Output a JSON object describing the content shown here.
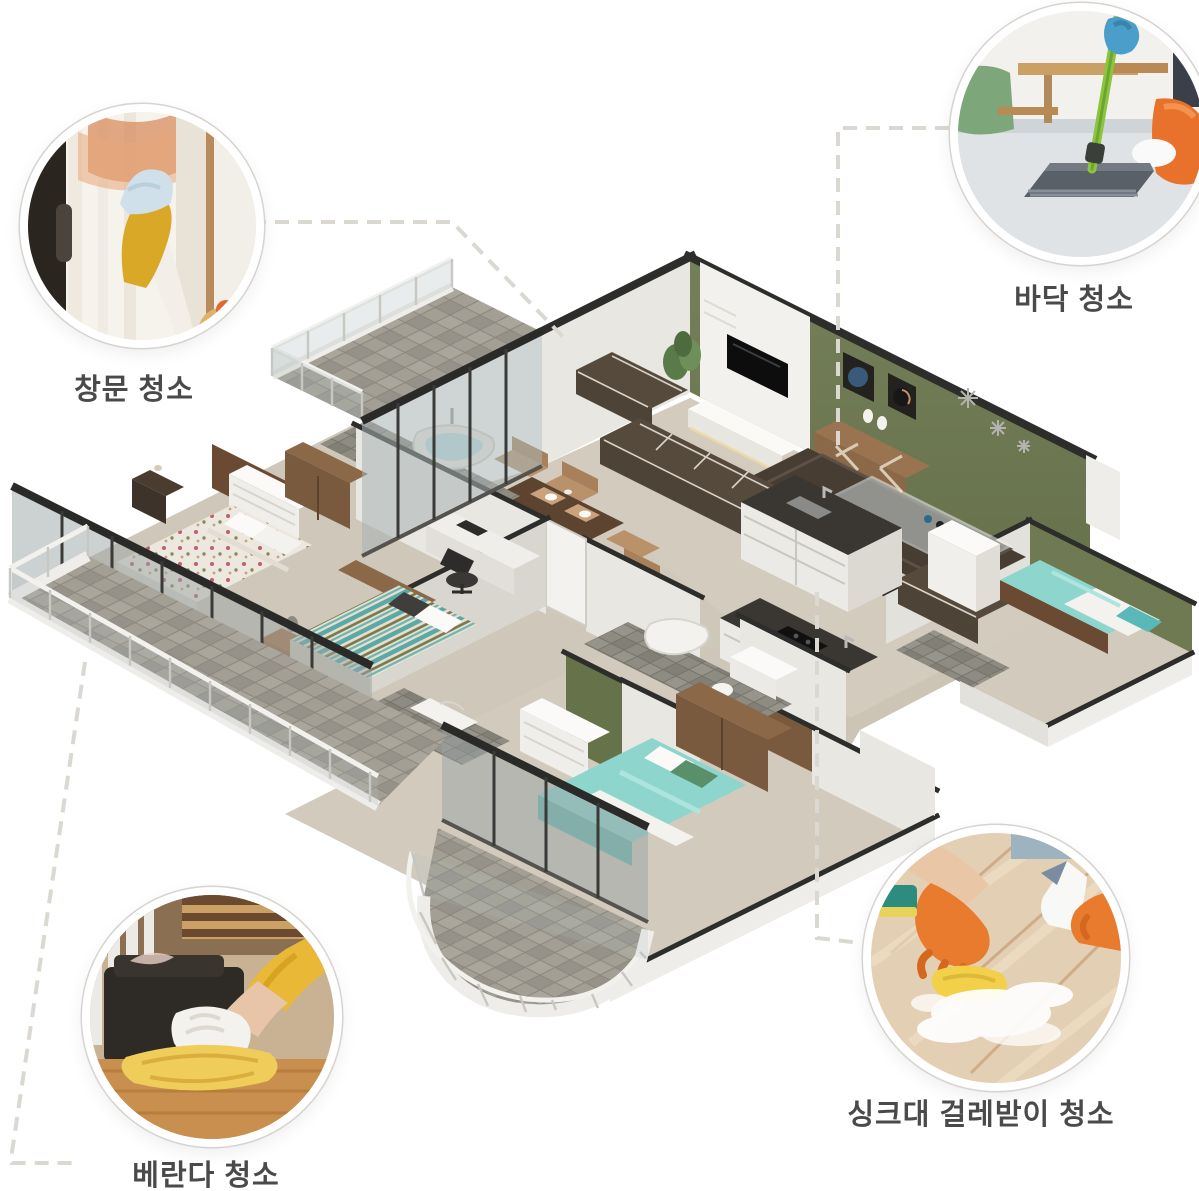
{
  "page": {
    "background": "#ffffff",
    "subject": "isometric apartment floor plan with four cleaning-service photo callouts"
  },
  "callouts": [
    {
      "id": "window-cleaning",
      "label": "창문 청소",
      "photo": "window-cleaning-photo"
    },
    {
      "id": "floor-cleaning",
      "label": "바닥 청소",
      "photo": "floor-mopping-photo"
    },
    {
      "id": "veranda-cleaning",
      "label": "베란다 청소",
      "photo": "veranda-wiping-photo"
    },
    {
      "id": "sink-baseboard-cleaning",
      "label": "싱크대 걸레받이 청소",
      "photo": "sink-baseboard-scrubbing-photo"
    }
  ],
  "floorplan": {
    "style": "isometric-3d",
    "rooms": [
      "living-room",
      "dining-area",
      "kitchen",
      "master-bedroom",
      "middle-bedroom",
      "bottom-bedroom",
      "right-bedroom",
      "bathroom-top",
      "bathroom-bottom",
      "balcony-top-left",
      "balcony-left",
      "balcony-bottom"
    ]
  },
  "colors": {
    "label_text": "#4a4a4a",
    "connector_dash": "#dad8d1",
    "wall_green": "#6f7a52",
    "accent_wall_green": "#66734a",
    "wall_white": "#e9e7e2",
    "wall_top_dark": "#2d2d2b",
    "floor_beige": "#cfc8ba",
    "balcony_tile_gray": "#a39f94",
    "sofa_brown": "#4e4337",
    "rug_brown": "#473d33",
    "wood_brown": "#7a5a3e",
    "bed_teal": "#8ed5cd",
    "granite_dark": "#3a3733",
    "glove_yellow": "#d9a827",
    "glove_orange": "#e87b2e",
    "mop_green": "#8bc53f"
  }
}
